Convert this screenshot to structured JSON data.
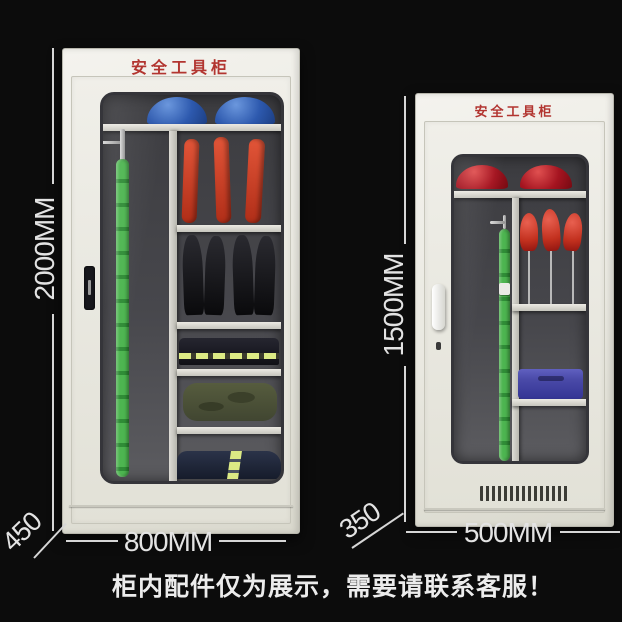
{
  "caption": "柜内配件仅为展示，需要请联系客服！",
  "cabinets": {
    "left": {
      "label": "安全工具柜",
      "height": "2000MM",
      "width": "800MM",
      "depth": "450"
    },
    "right": {
      "label": "安全工具柜",
      "height": "1500MM",
      "width": "500MM",
      "depth": "350"
    }
  },
  "colors": {
    "background": "#0c0c0c",
    "cabinet_body": "#edece4",
    "title_red": "#b23530",
    "dimension_text": "#e3e3e3",
    "helmet_blue": "#2d59ae",
    "helmet_red": "#a51420",
    "glove_red": "#c2301e",
    "rod_green": "#3aa23f",
    "reflective_lime": "#dcea84",
    "case_blue": "#4a4aa8"
  }
}
